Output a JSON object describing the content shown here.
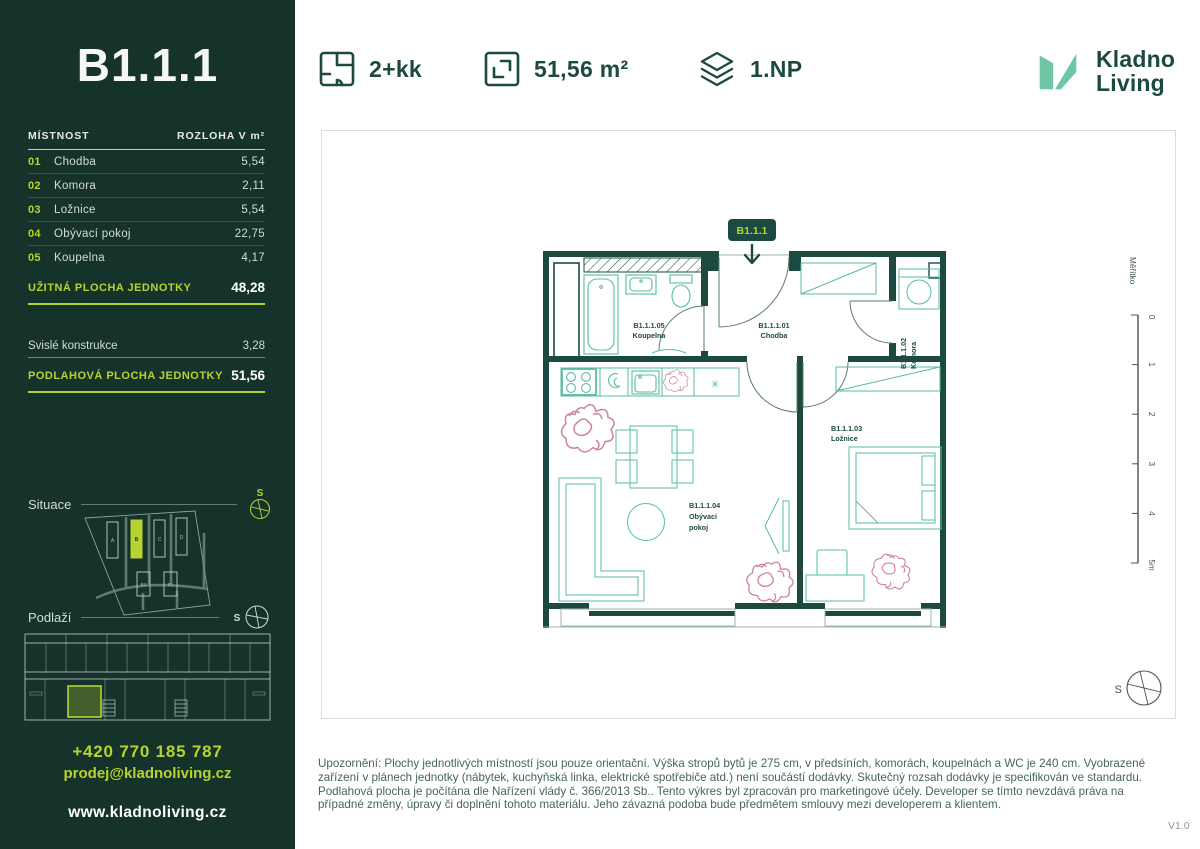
{
  "header": {
    "specs": [
      {
        "icon": "floorplan-icon",
        "label": "2+kk"
      },
      {
        "icon": "area-icon",
        "label": "51,56 m²"
      },
      {
        "icon": "floor-icon",
        "label": "1.NP"
      }
    ],
    "logo": {
      "line1": "Kladno",
      "line2": "Living"
    }
  },
  "sidebar": {
    "unit_title": "B1.1.1",
    "table": {
      "col_room": "MÍSTNOST",
      "col_area": "ROZLOHA V m²",
      "rows": [
        {
          "num": "01",
          "name": "Chodba",
          "area": "5,54"
        },
        {
          "num": "02",
          "name": "Komora",
          "area": "2,11"
        },
        {
          "num": "03",
          "name": "Ložnice",
          "area": "5,54"
        },
        {
          "num": "04",
          "name": "Obývací pokoj",
          "area": "22,75"
        },
        {
          "num": "05",
          "name": "Koupelna",
          "area": "4,17"
        }
      ],
      "usable_label": "UŽITNÁ PLOCHA JEDNOTKY",
      "usable_value": "48,28",
      "vertical_label": "Svislé konstrukce",
      "vertical_value": "3,28",
      "floor_label": "PODLAHOVÁ PLOCHA JEDNOTKY",
      "floor_value": "51,56"
    },
    "situace_label": "Situace",
    "podlazi_label": "Podlaží",
    "compass_letter": "S",
    "site_map": {
      "buildings": {
        "a": "A",
        "b": "B",
        "c": "C",
        "d": "D",
        "b2": "B2",
        "b1": "B1"
      }
    },
    "contact": {
      "phone": "+420 770 185 787",
      "email": "prodej@kladnoliving.cz",
      "web": "www.kladnoliving.cz"
    }
  },
  "plan": {
    "badge": "B1.1.1",
    "rooms": {
      "chodba": {
        "code": "B1.1.1.01",
        "name": "Chodba"
      },
      "komora": {
        "code": "B1.1.1.02",
        "name": "Komora"
      },
      "loznice": {
        "code": "B1.1.1.03",
        "name": "Ložnice"
      },
      "obyvaci": {
        "code": "B1.1.1.04",
        "name_line1": "Obývací",
        "name_line2": "pokoj"
      },
      "koupelna": {
        "code": "B1.1.1.05",
        "name": "Koupelna"
      }
    },
    "scale": {
      "label": "Měřítko",
      "ticks": [
        "0",
        "1",
        "2",
        "3",
        "4",
        "5m"
      ]
    },
    "compass_letter": "S"
  },
  "footer": {
    "disclaimer": "Upozornění: Plochy jednotlivých místností jsou pouze orientační. Výška stropů bytů je 275 cm, v předsíních, komorách, koupelnách a WC je 240 cm. Vyobrazené zařízení v plánech jednotky (nábytek, kuchyňská linka, elektrické spotřebiče atd.) není součástí dodávky. Skutečný rozsah dodávky je specifikován ve standardu. Podlahová plocha je počítána dle Nařízení vlády č. 366/2013 Sb.. Tento výkres byl zpracován pro marketingové účely. Developer se tímto nevzdává práva na případné změny, úpravy či doplnění tohoto materiálu. Jeho závazná podoba bude předmětem smlouvy mezi developerem a klientem.",
    "version": "V1.0"
  },
  "colors": {
    "sidebar_bg": "#15332b",
    "accent_lime": "#b6d331",
    "dark_green": "#1d4a40",
    "mint": "#57bda0",
    "plant_pink": "#cf8496"
  }
}
